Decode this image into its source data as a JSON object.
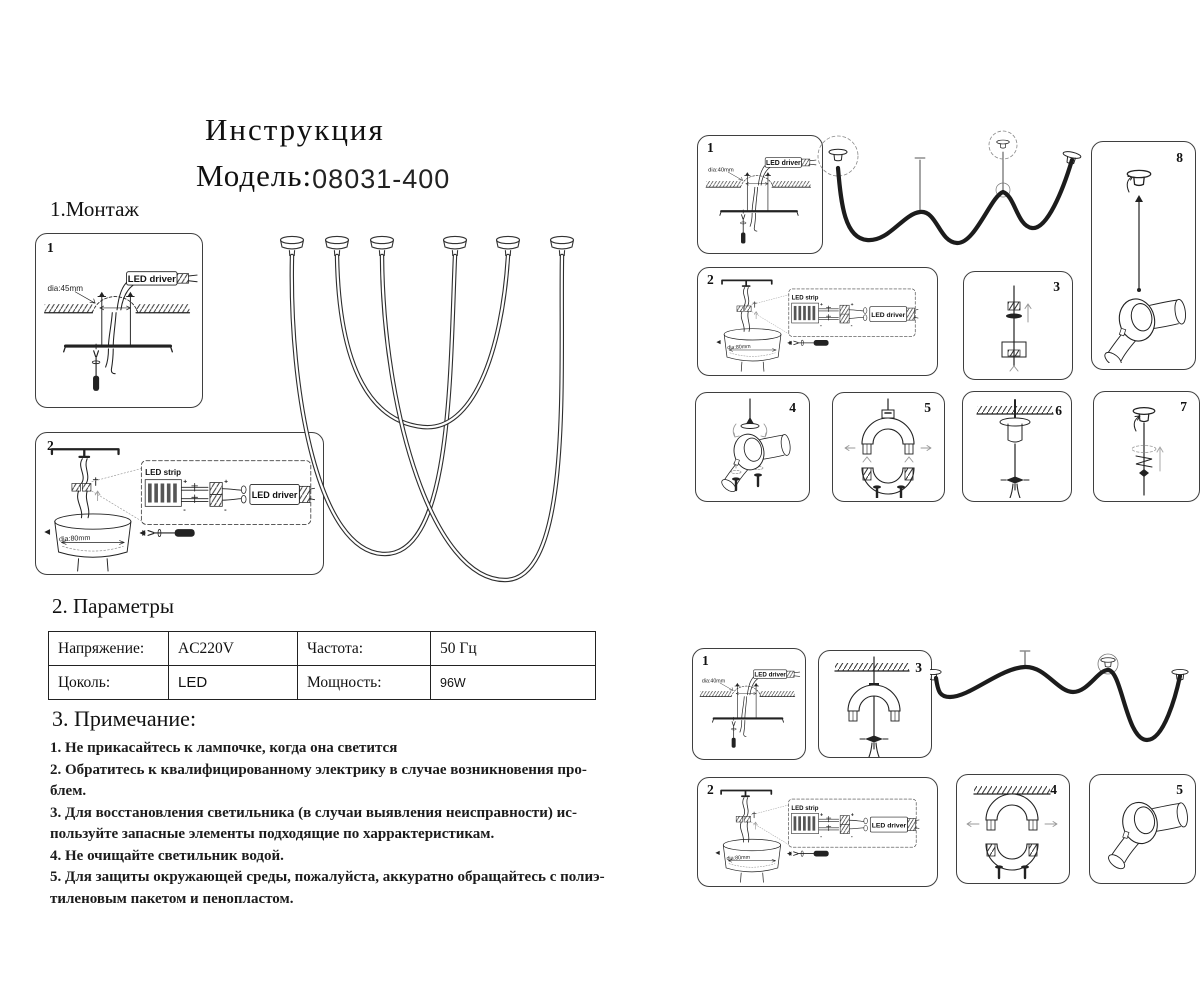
{
  "doc": {
    "title": "Инструкция",
    "model_label": "Модель:",
    "model_number": "08031-400",
    "section_montage": "1.Монтаж",
    "section_params": "2. Параметры",
    "section_notes": "3. Примечание:"
  },
  "table": {
    "r1c1": "Напряжение:",
    "r1c2": "AC220V",
    "r1c3": "Частота:",
    "r1c4": "50 Гц",
    "r2c1": "Цоколь:",
    "r2c2": "LED",
    "r2c3": "Мощность:",
    "r2c4": "96W"
  },
  "notes": [
    "1. Не прикасайтесь к лампочке, когда она светится",
    "2. Обратитесь к квалифицированному электрику в случае возникновения про-",
    "блем.",
    "3. Для восстановления светильника (в случаи выявления неисправности) ис-",
    "пользуйте запасные элементы подходящие по харрактеристикам.",
    "4. Не очищайте  светильник водой.",
    "5. Для защиты окружающей среды, пожалуйста, аккуратно обращайтесь с полиэ-",
    "тиленовым пакетом и пенопластом."
  ],
  "labels": {
    "led_driver": "LED driver",
    "led_strip": "LED strip",
    "dia45": "dia:45mm",
    "dia40": "dia:40mm",
    "dia80": "dia:80mm",
    "plus": "+",
    "minus": "-"
  },
  "panels": {
    "l1": "1",
    "l2": "2",
    "r1": "1",
    "r2": "2",
    "r3": "3",
    "r4": "4",
    "r5": "5",
    "r6": "6",
    "r7": "7",
    "r8": "8",
    "b1": "1",
    "b2": "2",
    "b3": "3",
    "b4": "4",
    "b5": "5"
  }
}
